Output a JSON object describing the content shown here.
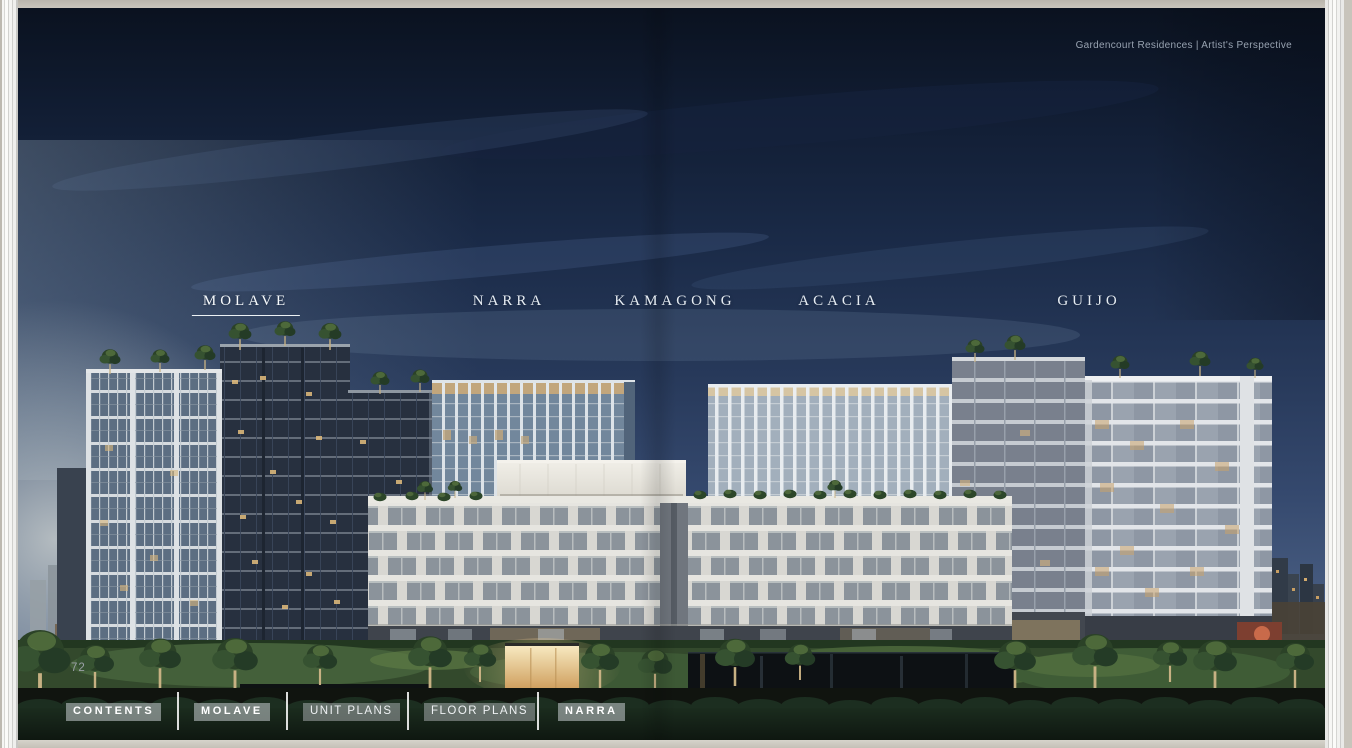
{
  "document": {
    "caption": "Gardencourt Residences | Artist's Perspective",
    "page_number": "72"
  },
  "building_labels": [
    {
      "name": "MOLAVE",
      "active": true
    },
    {
      "name": "NARRA",
      "active": false
    },
    {
      "name": "KAMAGONG",
      "active": false
    },
    {
      "name": "ACACIA",
      "active": false
    },
    {
      "name": "GUIJO",
      "active": false
    }
  ],
  "nav": {
    "items": [
      {
        "label": "CONTENTS",
        "style": "bold"
      },
      {
        "label": "MOLAVE",
        "style": "bold"
      },
      {
        "label": "UNIT PLANS",
        "style": "regular"
      },
      {
        "label": "FLOOR PLANS",
        "style": "regular"
      },
      {
        "label": "NARRA",
        "style": "bold"
      }
    ]
  },
  "scene": {
    "description": "Dusk artist's perspective rendering of five residential towers over a garden podium with pools, hedges and a glowing pavilion"
  },
  "colors": {
    "sky_top": "#0a111e",
    "sky_horizon": "#66788f",
    "label_text": "#e6ecf2",
    "nav_highlight": "#c9ced1",
    "frame_background": "#c8c4bb"
  }
}
